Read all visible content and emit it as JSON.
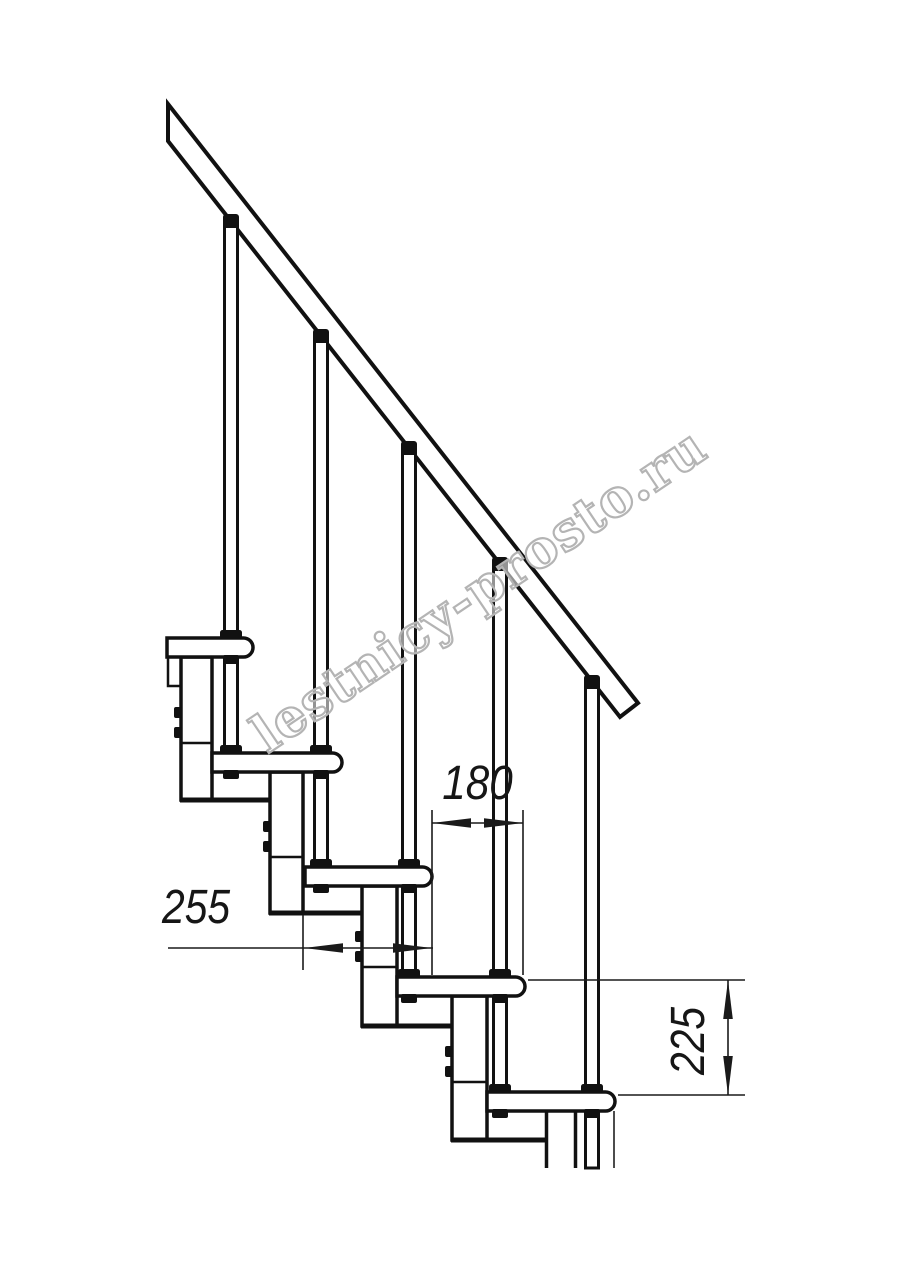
{
  "page": {
    "background_color": "#ffffff"
  },
  "drawing": {
    "kind": "staircase-side-elevation-line-drawing",
    "steps_visible": 5,
    "ink_color": "#111111"
  },
  "watermark": {
    "text": "lestnicy-prosto.ru",
    "outline_color": "#b4b4b4"
  },
  "annotations": {
    "dim_tread_depth": {
      "value": "255",
      "orientation": "horizontal"
    },
    "dim_step_run": {
      "value": "180",
      "orientation": "horizontal"
    },
    "dim_step_rise": {
      "value": "225",
      "orientation": "vertical"
    }
  }
}
